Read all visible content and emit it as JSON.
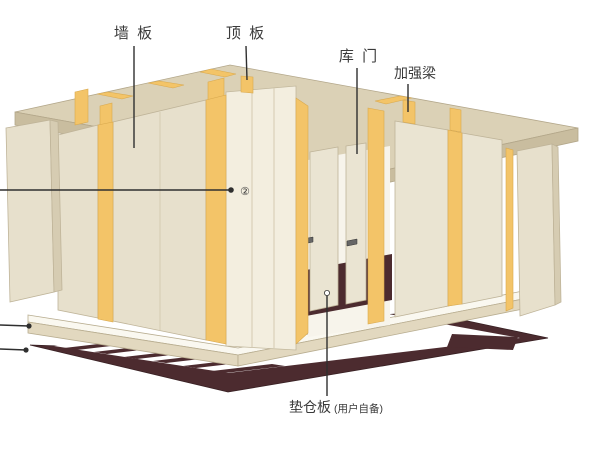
{
  "diagram": {
    "type": "cold-room-assembly-exploded-view",
    "labels": {
      "wall_panel": "墙 板",
      "ceiling_panel": "顶 板",
      "door": "库 门",
      "reinforcing_beam": "加强梁",
      "callout": "②",
      "pallet_main": "垫仓板",
      "pallet_note": "(用户自备)"
    },
    "colors": {
      "background": "#ffffff",
      "ceiling_top": "#dbd1b6",
      "ceiling_edge": "#c9bd9f",
      "panel_face": "#e7e0cc",
      "panel_face_right": "#eae4d2",
      "panel_face_bright": "#f3eedf",
      "panel_side": "#d6ccb2",
      "joint_yellow": "#f3c468",
      "door_opening": "#f7f4eb",
      "floor_top": "#faf8f0",
      "floor_edge": "#e2d8bf",
      "pallet_dark": "#4c2b2f",
      "leader_line": "#2f2f2f",
      "text": "#3a3a3a"
    }
  }
}
